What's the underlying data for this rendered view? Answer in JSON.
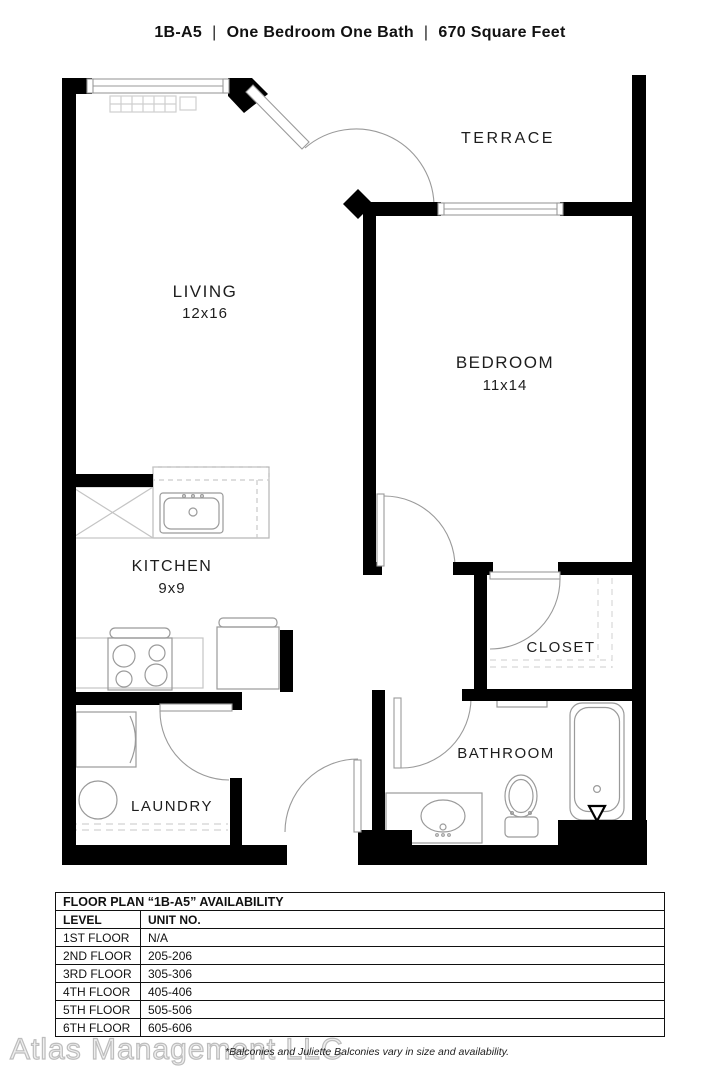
{
  "title": {
    "plan_code": "1B-A5",
    "separator": "|",
    "description": "One Bedroom One Bath",
    "area": "670 Square Feet"
  },
  "floor_plan": {
    "rooms": {
      "terrace": {
        "label": "TERRACE"
      },
      "living": {
        "label": "LIVING",
        "dims": "12x16"
      },
      "bedroom": {
        "label": "BEDROOM",
        "dims": "11x14"
      },
      "kitchen": {
        "label": "KITCHEN",
        "dims": "9x9"
      },
      "closet": {
        "label": "CLOSET"
      },
      "bathroom": {
        "label": "BATHROOM"
      },
      "laundry": {
        "label": "LAUNDRY"
      }
    },
    "fixtures": [
      "window",
      "terrace-door",
      "kitchen-sink",
      "refrigerator",
      "range",
      "dishwasher",
      "washer",
      "bathroom-vanity",
      "toilet",
      "bathtub",
      "closet-shelf"
    ]
  },
  "availability_table": {
    "title": "FLOOR PLAN “1B-A5” AVAILABILITY",
    "columns": [
      "LEVEL",
      "UNIT NO."
    ],
    "rows": [
      [
        "1ST FLOOR",
        "N/A"
      ],
      [
        "2ND FLOOR",
        "205-206"
      ],
      [
        "3RD FLOOR",
        "305-306"
      ],
      [
        "4TH FLOOR",
        "405-406"
      ],
      [
        "5TH FLOOR",
        "505-506"
      ],
      [
        "6TH FLOOR",
        "605-606"
      ]
    ]
  },
  "footer": {
    "watermark": "Atlas Management LLC",
    "note": "*Balconies and Juliette Balconies vary in size and availability."
  },
  "colors": {
    "wall": "#000000",
    "fixture_outline": "#aaaaaa",
    "text": "#1d1d1d",
    "watermark": "#bdbdbd"
  }
}
